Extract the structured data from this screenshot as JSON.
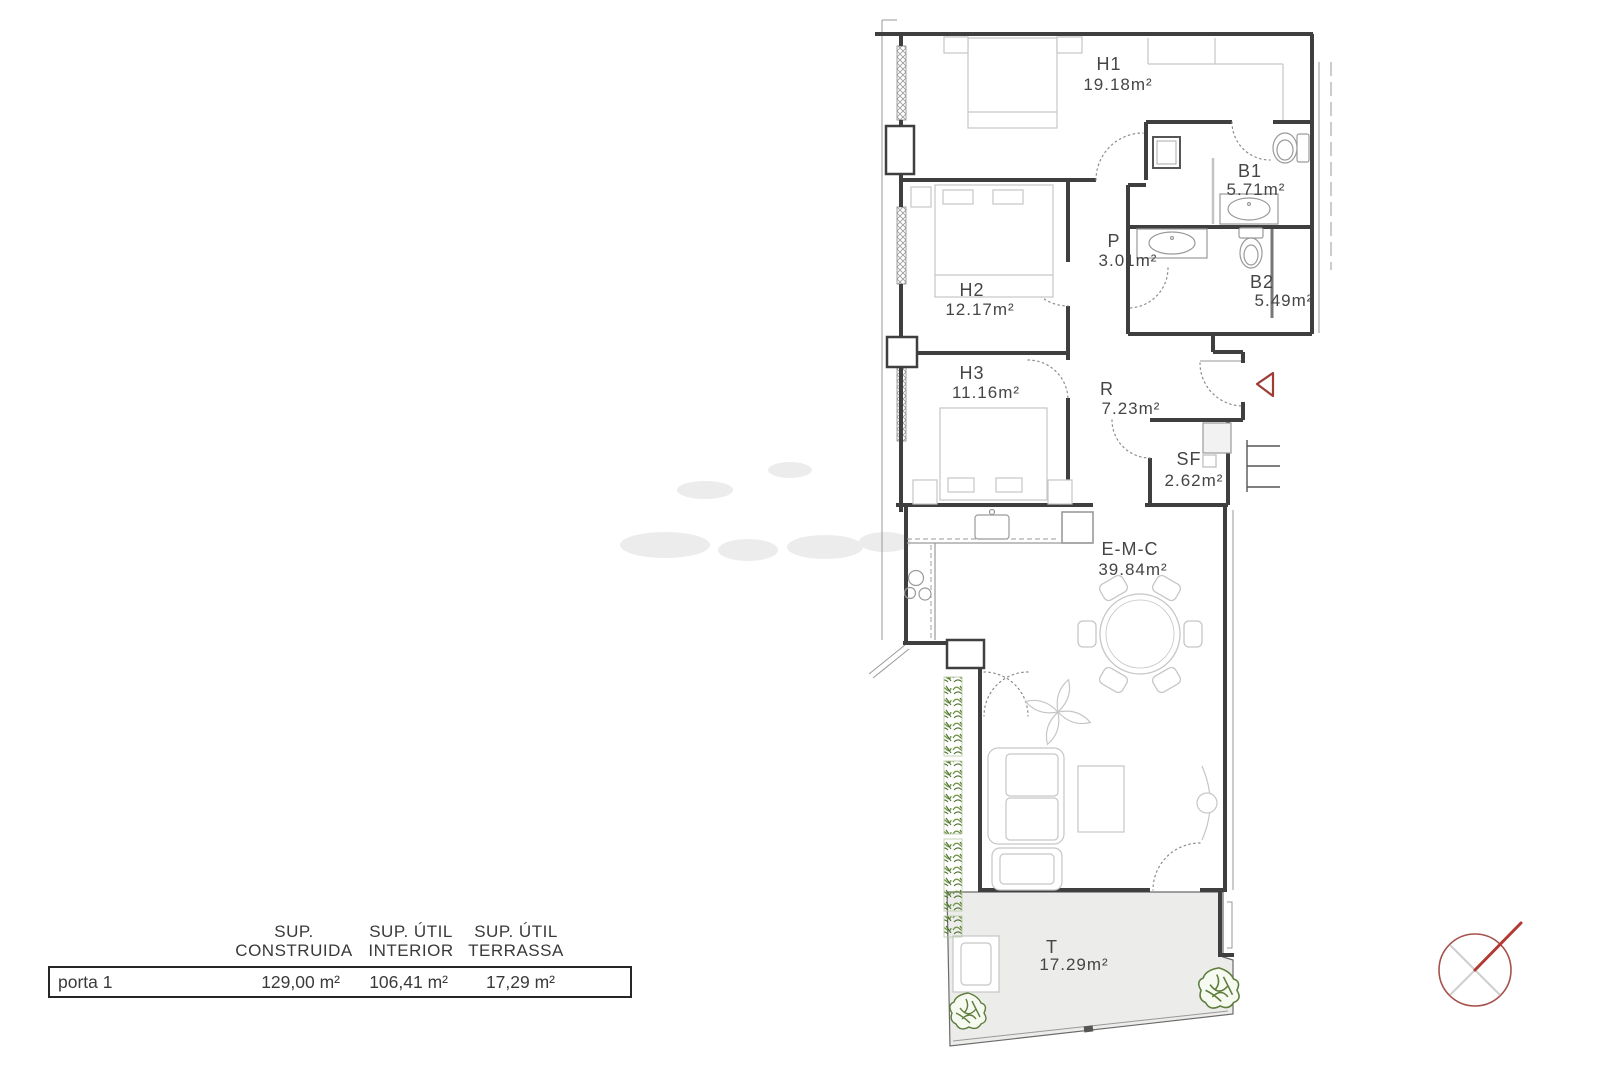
{
  "plan": {
    "rooms": [
      {
        "code": "H1",
        "area": "19.18m²"
      },
      {
        "code": "B1",
        "area": "5.71m²"
      },
      {
        "code": "P",
        "area": "3.01m²"
      },
      {
        "code": "H2",
        "area": "12.17m²"
      },
      {
        "code": "B2",
        "area": "5.49m²"
      },
      {
        "code": "H3",
        "area": "11.16m²"
      },
      {
        "code": "R",
        "area": "7.23m²"
      },
      {
        "code": "SF",
        "area": "2.62m²"
      },
      {
        "code": "E-M-C",
        "area": "39.84m²"
      },
      {
        "code": "T",
        "area": "17.29m²"
      }
    ],
    "colors": {
      "wall": "#3f3f3f",
      "furniture": "#c6c6c6",
      "fixture": "#9a9a9a",
      "door_arc": "#8a8a8a",
      "terrace_fill": "#ececea",
      "hedge_green": "#6d9645",
      "hedge_green_dark": "#4e7030",
      "bush_green": "#5c7d3c",
      "entrance_red": "#9e3c34",
      "compass_ring": "#a5524c",
      "compass_needle": "#b23a32"
    }
  },
  "summary_table": {
    "row_label": "porta 1",
    "columns": [
      {
        "header_line1": "SUP.",
        "header_line2": "CONSTRUIDA",
        "value": "129,00 m²"
      },
      {
        "header_line1": "SUP. ÚTIL",
        "header_line2": "INTERIOR",
        "value": "106,41 m²"
      },
      {
        "header_line1": "SUP. ÚTIL",
        "header_line2": "TERRASSA",
        "value": "17,29 m²"
      }
    ]
  }
}
